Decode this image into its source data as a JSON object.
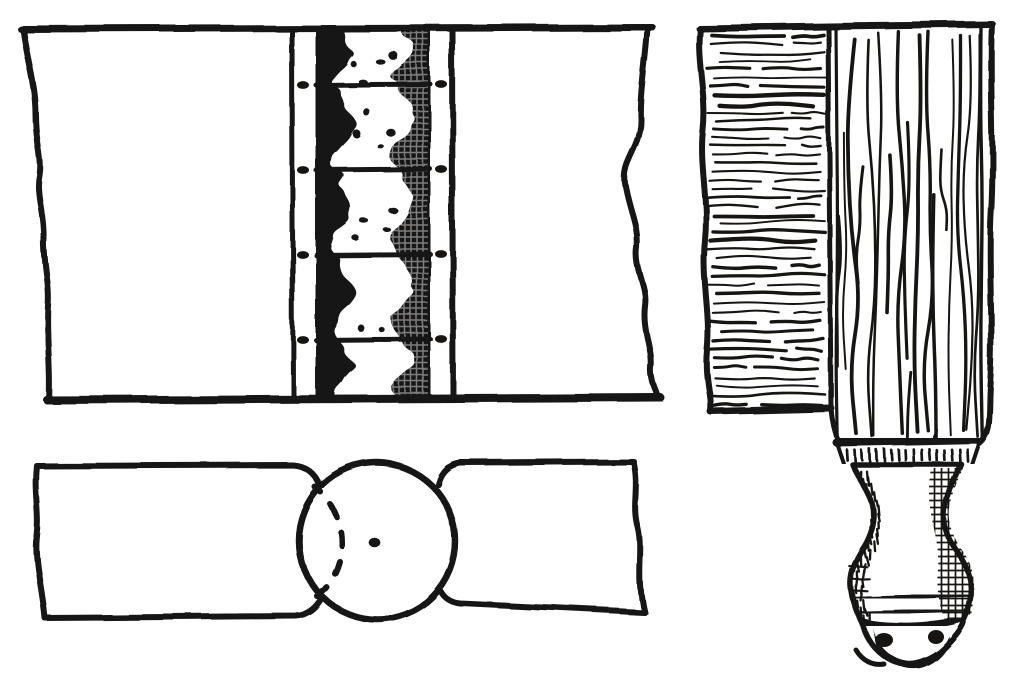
{
  "document": {
    "type": "scanned-line-illustration",
    "subject": "knuckle joint and turned table leg",
    "visible_text": ""
  },
  "colors": {
    "ink": "#171512",
    "paper": "#ffffff"
  },
  "figures": [
    {
      "id": "plan",
      "label": "knuckle-joint-plan-view"
    },
    {
      "id": "edge",
      "label": "knuckle-joint-edge-view"
    },
    {
      "id": "leg",
      "label": "leg-and-rail-elevation"
    }
  ]
}
